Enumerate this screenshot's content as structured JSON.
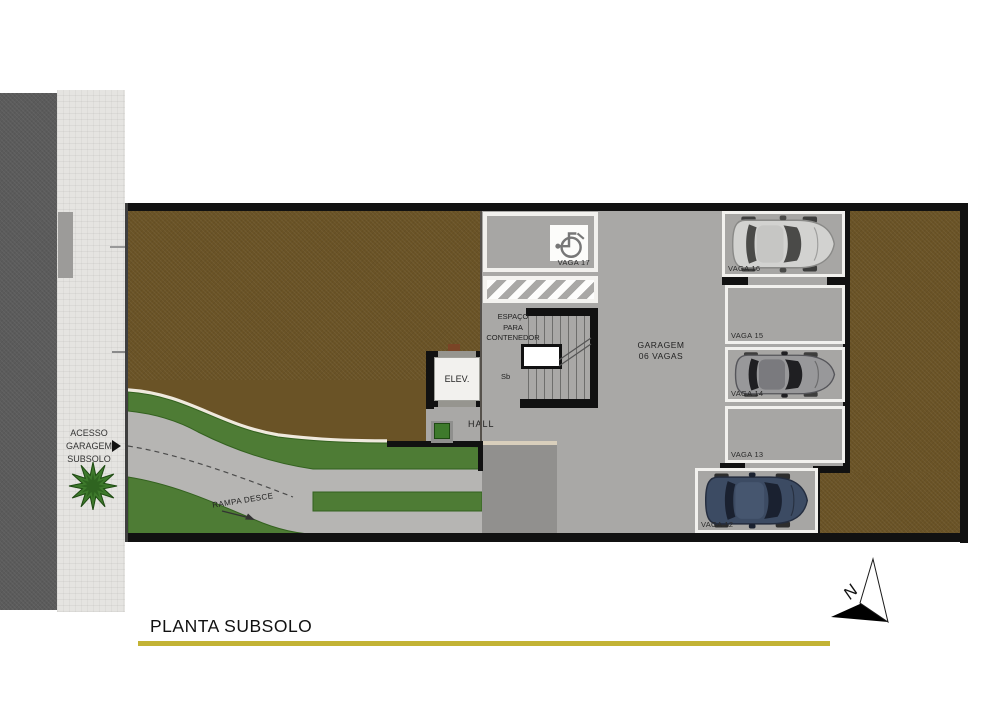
{
  "title": {
    "text": "PLANTA SUBSOLO"
  },
  "access": {
    "line1": "ACESSO",
    "line2": "GARAGEM",
    "line3": "SUBSOLO"
  },
  "ramp": {
    "label": "RAMPA DESCE"
  },
  "hall": {
    "label": "HALL"
  },
  "elevator": {
    "label": "ELEV."
  },
  "stairs": {
    "direction_label": "Sb"
  },
  "container_space": {
    "line1": "ESPAÇO",
    "line2": "PARA",
    "line3": "CONTENEDOR"
  },
  "garage": {
    "line1": "GARAGEM",
    "line2": "06 VAGAS"
  },
  "compass": {
    "label": "N"
  },
  "parking": {
    "spots": [
      {
        "label": "VAGA 17",
        "type": "accessible",
        "car": "none"
      },
      {
        "label": "VAGA 16",
        "type": "standard",
        "car": "silver"
      },
      {
        "label": "VAGA 15",
        "type": "standard",
        "car": "none"
      },
      {
        "label": "VAGA 14",
        "type": "standard",
        "car": "gray"
      },
      {
        "label": "VAGA 13",
        "type": "standard",
        "car": "none"
      },
      {
        "label": "VAGA 12",
        "type": "standard",
        "car": "blue"
      }
    ]
  },
  "colors": {
    "accent_underline": "#c3b335",
    "street": "#5b5b5b",
    "sidewalk": "#e5e4e1",
    "earth": "#6a5326",
    "garage_floor": "#a9a8a6",
    "ramp": "#b6b5b3",
    "grass": "#4e7c35",
    "wall": "#111111",
    "car_silver": "#d2d2d0",
    "car_gray": "#98989a",
    "car_blue": "#3c4b63"
  }
}
